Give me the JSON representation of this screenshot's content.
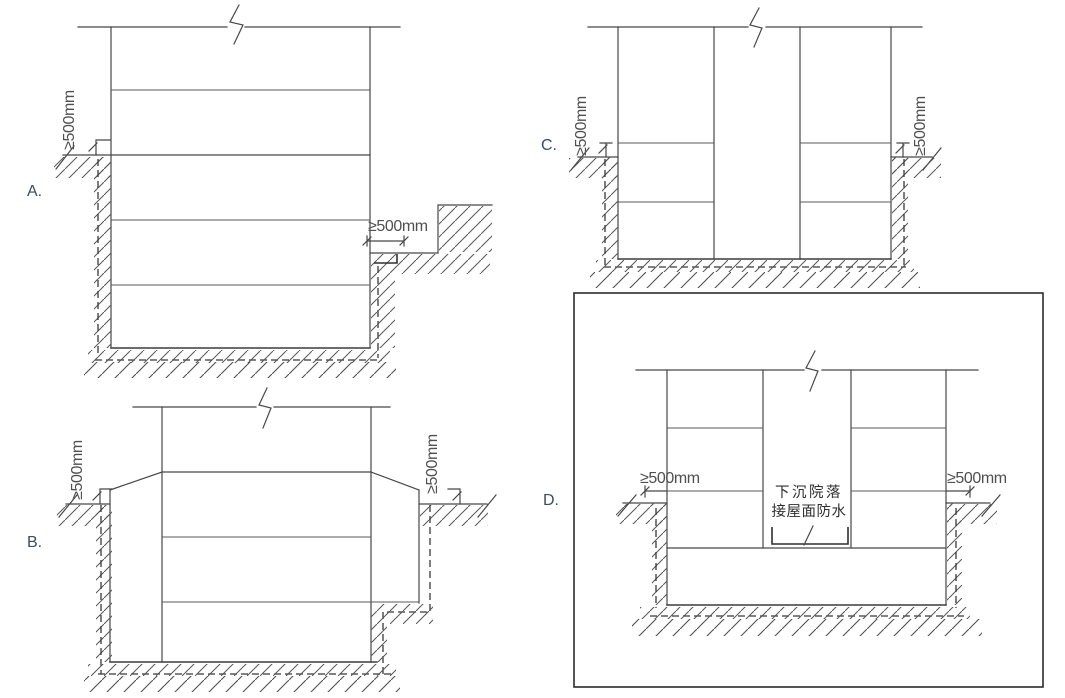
{
  "labels": {
    "a": "A.",
    "b": "B.",
    "c": "C.",
    "d": "D."
  },
  "dim": "≥500mm",
  "d_annotation": {
    "line1": "下沉院落",
    "line2": "接屋面防水"
  },
  "selected_option": "D",
  "colors": {
    "line": "#474747",
    "option_label": "#3d4b5c",
    "selected_border": "#2b2b2b",
    "background": "#ffffff"
  }
}
